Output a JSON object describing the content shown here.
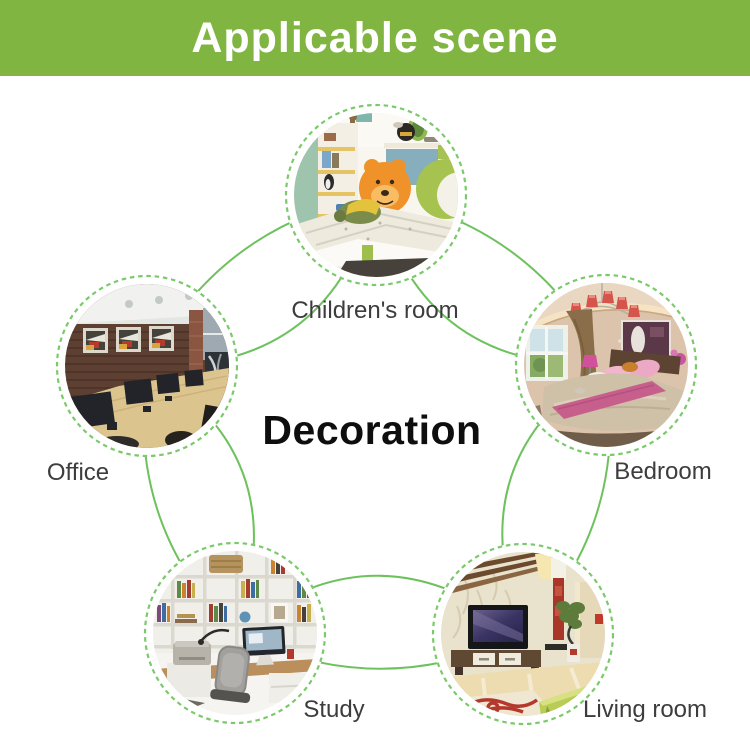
{
  "header": {
    "title": "Applicable scene"
  },
  "diagram": {
    "center_label": "Decoration",
    "scenes": [
      {
        "id": "childrens-room",
        "label": "Children's room"
      },
      {
        "id": "office",
        "label": "Office"
      },
      {
        "id": "bedroom",
        "label": "Bedroom"
      },
      {
        "id": "study",
        "label": "Study"
      },
      {
        "id": "living-room",
        "label": "Living room"
      }
    ]
  },
  "colors": {
    "header_bg": "#80b541",
    "header_text": "#ffffff",
    "connector_green": "#6ec25d",
    "dashed_border_green": "#7bc96b",
    "label_text": "#3d3d3d",
    "center_text": "#0e0e0e"
  }
}
